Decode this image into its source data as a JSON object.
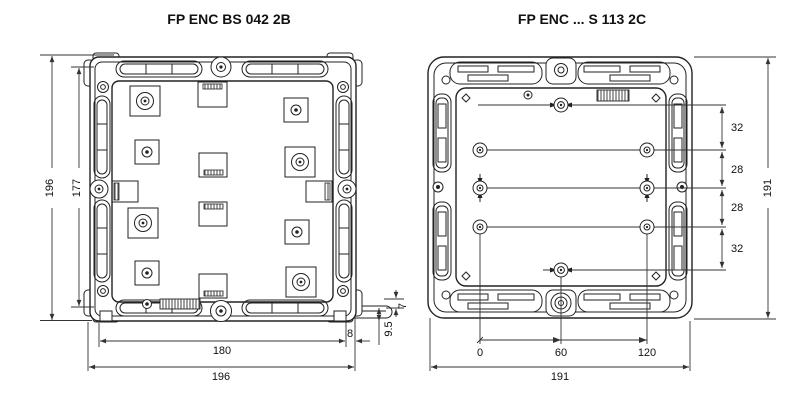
{
  "page": {
    "background": "#ffffff",
    "line_color": "#222222",
    "dim_color": "#333333"
  },
  "left": {
    "title": "FP ENC BS 042 2B",
    "dim_overall_height": "196",
    "dim_rail_height": "177",
    "dim_mounting_width": "180",
    "dim_overall_width": "196",
    "dim_foot_offset": "8",
    "dim_foot_depth": "9.5",
    "dim_flange_thickness": "7"
  },
  "right": {
    "title": "FP ENC ... S 113 2C",
    "dim_overall_height": "191",
    "dim_overall_width": "191",
    "row_spacings": [
      "32",
      "28",
      "28",
      "32"
    ],
    "hole_ordinates": [
      "0",
      "60",
      "120"
    ]
  }
}
